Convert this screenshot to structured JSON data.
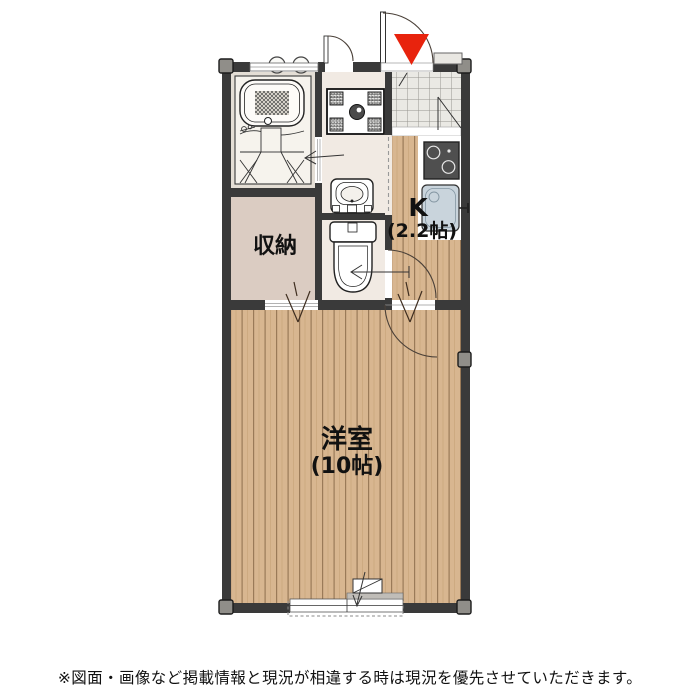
{
  "page": {
    "background": "#ffffff"
  },
  "floorplan": {
    "rooms": {
      "storage": {
        "label": "収納"
      },
      "kitchen": {
        "label": "K",
        "size_label": "(2.2帖)"
      },
      "western_room": {
        "label": "洋室",
        "size_label": "(10帖)"
      }
    },
    "colors": {
      "wall": "#3a3a3a",
      "entrance_marker": "#e8230d",
      "wood_floor": "#d8b690",
      "wood_plank_line": "#9a7a58",
      "storage_floor": "#dbccc2",
      "washroom_floor": "#f1eae3",
      "bathroom_floor": "#e4ded5",
      "tile_floor": "#eae9e4",
      "sink": "#c9d4dc"
    }
  },
  "footer": {
    "disclaimer": "※図面・画像など掲載情報と現況が相違する時は現況を優先させていただきます。"
  }
}
